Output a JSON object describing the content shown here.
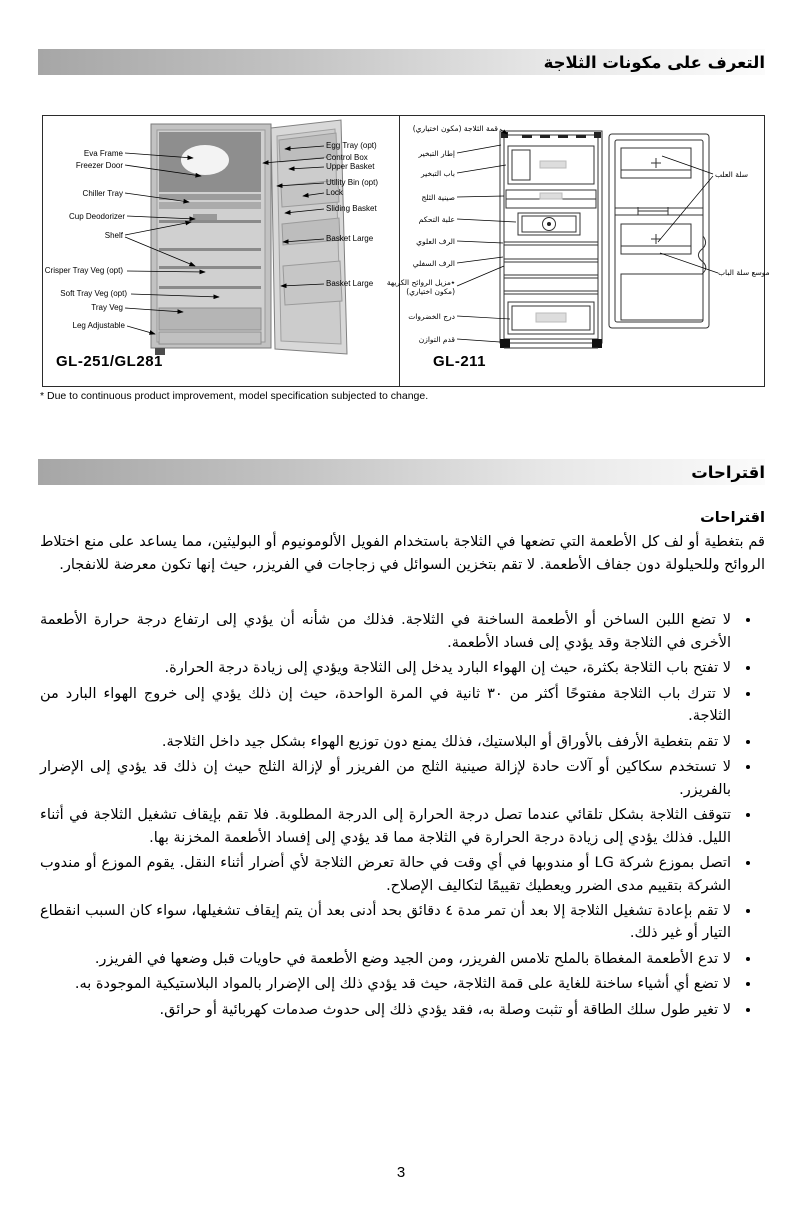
{
  "page_number": "3",
  "sections": {
    "components_title": "التعرف على مكونات الثلاجة",
    "suggestions_title": "اقتراحات"
  },
  "footnote": "* Due to continuous product improvement, model specification subjected to change.",
  "diagram": {
    "gl251": {
      "model": "GL-251/GL281",
      "labels_left": [
        "Eva Frame",
        "Freezer Door",
        "Chiller Tray",
        "Cup Deodorizer",
        "Shelf",
        "Crisper Tray Veg (opt)",
        "Soft Tray Veg (opt)",
        "Tray Veg",
        "Leg Adjustable"
      ],
      "labels_right": [
        "Egg Tray (opt)",
        "Control Box",
        "Upper Basket",
        "Utility Bin (opt)",
        "Lock",
        "Sliding Basket",
        "Basket Large",
        "Basket Large"
      ]
    },
    "gl211": {
      "model": "GL-211",
      "labels_left": [
        "قمة الثلاجة (مكون اختياري)",
        "إطار التبخير",
        "باب التبخير",
        "صينية الثلج",
        "علبة التحكم",
        "الرف العلوي",
        "الرف السفلي",
        "٭مزيل الروائح الكريهة",
        "(مكون اختياري)",
        "درج الخضروات",
        "قدم التوازن"
      ],
      "labels_right": [
        "سلة العلب",
        "موسع سلة الباب"
      ]
    }
  },
  "suggestions": {
    "heading": "اقتراحات",
    "intro": "قم بتغطية أو لف كل الأطعمة التي تضعها في الثلاجة باستخدام الفويل الألومونيوم أو البوليثين، مما يساعد على منع اختلاط الروائح وللحيلولة دون جفاف الأطعمة. لا تقم بتخزين السوائل في زجاجات في الفريزر، حيث إنها تكون معرضة للانفجار.",
    "bullets": [
      "لا تضع اللبن الساخن أو الأطعمة الساخنة في الثلاجة. فذلك من شأنه أن يؤدي إلى ارتفاع درجة حرارة الأطعمة الأخرى في الثلاجة وقد يؤدي إلى فساد الأطعمة.",
      "لا تفتح باب الثلاجة بكثرة، حيث إن الهواء البارد يدخل إلى الثلاجة ويؤدي إلى زيادة درجة الحرارة.",
      "لا تترك باب الثلاجة مفتوحًا أكثر من ٣٠ ثانية في المرة الواحدة، حيث إن ذلك يؤدي إلى خروج الهواء البارد من الثلاجة.",
      "لا تقم بتغطية الأرفف بالأوراق أو البلاستيك، فذلك يمنع دون توزيع الهواء بشكل جيد داخل الثلاجة.",
      "لا تستخدم سكاكين أو آلات حادة لإزالة صينية الثلج من الفريزر أو لإزالة الثلج حيث إن ذلك قد يؤدي إلى الإضرار بالفريزر.",
      "تتوقف الثلاجة بشكل تلقائي عندما تصل درجة الحرارة إلى الدرجة المطلوبة. فلا تقم بإيقاف تشغيل الثلاجة في أثناء الليل. فذلك يؤدي إلى زيادة درجة الحرارة في الثلاجة مما قد يؤدي إلى إفساد الأطعمة المخزنة بها.",
      "اتصل بموزع شركة LG أو مندوبها في أي وقت في حالة تعرض الثلاجة لأي أضرار أثناء النقل. يقوم الموزع أو مندوب الشركة بتقييم مدى الضرر ويعطيك تقييمًا لتكاليف الإصلاح.",
      "لا تقم بإعادة تشغيل الثلاجة إلا بعد أن تمر مدة ٤ دقائق بحد أدنى بعد أن يتم إيقاف تشغيلها، سواء كان السبب انقطاع التيار أو غير ذلك.",
      "لا تدع الأطعمة المغطاة بالملح تلامس الفريزر، ومن الجيد وضع الأطعمة في حاويات قبل وضعها في الفريزر.",
      "لا تضع أي أشياء ساخنة للغاية على قمة الثلاجة، حيث قد يؤدي ذلك إلى الإضرار بالمواد البلاستيكية الموجودة به.",
      "لا تغير طول سلك الطاقة أو تثبت وصلة به، فقد يؤدي ذلك إلى حدوث صدمات كهربائية أو حرائق."
    ]
  }
}
